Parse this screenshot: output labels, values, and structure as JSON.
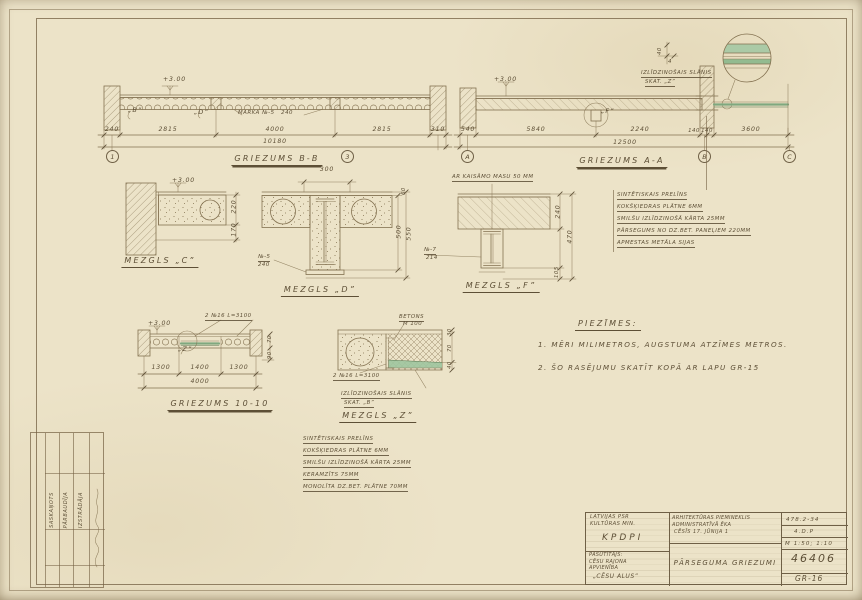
{
  "colors": {
    "paper": "#ece3c8",
    "ink": "#837150",
    "text": "#5d4f36",
    "green": "#7fa87f"
  },
  "sections": {
    "bb": {
      "title": "GRIEZUMS B-B",
      "elevation": "+3.00",
      "detail_b": "„B”",
      "detail_d": "„D”",
      "beam_note": "MARKA №-5   240",
      "dims": [
        "240",
        "2815",
        "4000",
        "2815",
        "310"
      ],
      "total": "10180",
      "axis_left": "1",
      "axis_right": "3"
    },
    "aa": {
      "title": "GRIEZUMS A-A",
      "elevation": "+3.00",
      "detail_f": "„F”",
      "callout_line1": "IZLĪDZINOŠAIS SLĀNIS",
      "callout_line2": "SKAT. „Z”",
      "callout_dim_v": "40",
      "callout_dim_h": "4",
      "dims": [
        "540",
        "5840",
        "2240",
        "140",
        "140",
        "3600"
      ],
      "total": "12500",
      "axes": [
        "A",
        "B",
        "C"
      ]
    },
    "c": {
      "title": "MEZGLS „C”",
      "elevation": "+3.00",
      "dim1": "220",
      "dim2": "170"
    },
    "d": {
      "title": "MEZGLS „D”",
      "dim_top": "300",
      "dim_small": "60",
      "dim1": "500",
      "dim2": "550",
      "note1": "№-5",
      "note2": "240"
    },
    "f": {
      "title": "MEZGLS „F”",
      "top_note": "AR KAISĀMO MASU 50 MM",
      "note1": "№-7",
      "note2": "214",
      "dim1": "240",
      "dim2": "470",
      "dim3": "105"
    },
    "g1010": {
      "title": "GRIEZUMS 10-10",
      "elevation": "+3.00",
      "top_note": "2 №16 L=3100",
      "detail_z": "„Z”",
      "dims": [
        "1300",
        "1400",
        "1300"
      ],
      "total": "4000",
      "dim_r1": "70",
      "dim_r2": "90"
    },
    "z": {
      "title": "MEZGLS „Z”",
      "note_betons1": "BETONS",
      "note_betons2": "M 100",
      "note_channel": "2 №16 L=3100",
      "callout_line1": "IZLĪDZINOŠAIS SLĀNIS",
      "callout_line2": "SKAT. „B”",
      "dim1": "30",
      "dim2": "70",
      "dim3": "40"
    }
  },
  "notes_block": {
    "lines": [
      "SINTĒTISKAIS PRELĪNS",
      "KOKŠĶIEDRAS PLĀTNE 6MM",
      "SMILŠU IZLĪDZINOŠĀ KĀRTA 25MM",
      "PĀRSEGUMS NO DZ.BET. PANEĻIEM 220MM",
      "APMESTAS METĀLA SIJAS"
    ]
  },
  "floor_layers": {
    "lines": [
      "SINTĒTISKAIS PRELĪNS",
      "KOKŠĶIEDRAS PLĀTNE 6MM",
      "SMILŠU IZLĪDZINOŠĀ KĀRTA 25MM",
      "KERAMZĪTS 75MM",
      "MONOLĪTA DZ.BET. PLĀTNE 70MM"
    ]
  },
  "piezimes": {
    "heading": "PIEZĪMES:",
    "line1": "1. MĒRI MILIMETROS, AUGSTUMA ATZĪMES METROS.",
    "line2": "2. ŠO RASĒJUMU SKATĪT KOPĀ AR LAPU GR-15"
  },
  "title_block": {
    "org_line1": "LATVIJAS PSR",
    "org_line2": "KULTŪRAS MIN.",
    "org_abbr": "KPDPI",
    "client_label": "PASŪTĪTĀJS:",
    "client_line1": "CĒSU RAJONA",
    "client_line2": "APVIENĪBA",
    "client_line3": "„CĒSU ALUS”",
    "object_line1": "ARHITEKTŪRAS PIEMINEKLIS",
    "object_line2": "ADMINISTRATĪVĀ ĒKA",
    "object_line3": "CĒSĪS 17. JŪNIJA 1",
    "drawing_title": "PĀRSEGUMA GRIEZUMI",
    "code": "478.2-34",
    "stage": "4.D.P",
    "scale": "M 1:50; 1:10",
    "number": "46406",
    "sheet": "GR-16"
  },
  "margin_table": {
    "row1": "IZSTRĀDĀJA",
    "row2": "PĀRBAUDĪJA",
    "row3": "SASKAŅOTS"
  }
}
